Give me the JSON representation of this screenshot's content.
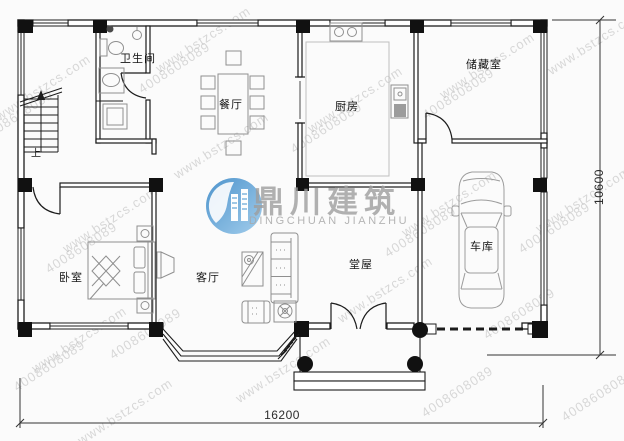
{
  "plan": {
    "rooms": {
      "bathroom": "卫生间",
      "dining": "餐厅",
      "kitchen": "厨房",
      "storage": "储藏室",
      "bedroom": "卧室",
      "living": "客厅",
      "hall": "堂屋",
      "garage": "车库"
    },
    "stair_up": "上",
    "dimensions": {
      "width": "16200",
      "height": "10600"
    }
  },
  "brand": {
    "logo_cn": "鼎川建筑",
    "logo_en": "DINGCHUAN JIANZHU"
  },
  "watermark": {
    "site": "www.bstzcs.com",
    "phone": "4008608089"
  }
}
